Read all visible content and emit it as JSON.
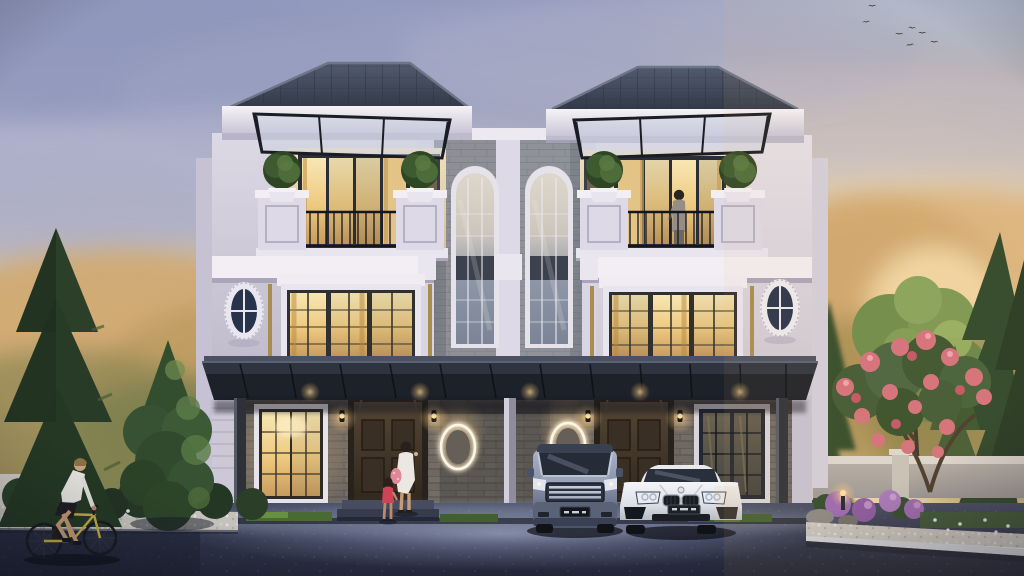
{
  "scene": {
    "description": "Dusk architectural rendering of a symmetrical three-storey twin townhouse (duplex) with hip roofs, white classical facades, a grey stone-clad centre tower with two tall arched windows, balconies with black iron railings and glass awning canopies, a dark carport sheltering a silver-blue minivan and a white sports sedan, warm glowing windows, a woman with a child at the left entrance, a resident on the right balcony, a cyclist passing on the road, pine trees and a pink flowering garden at dusk with birds in the sky",
    "time_of_day": "dusk",
    "weather": "clear with soft clouds",
    "setting": "residential street front"
  },
  "palette": {
    "sky-top": "#939bc0",
    "sky-mid": "#cfc2b2",
    "sky-warm": "#f0d8b4",
    "cloud": "#9aa0c0",
    "roof": "#414a5a",
    "fascia": "#efecf2",
    "wall-light": "#dfdbe6",
    "wall-shadow": "#b9b5ca",
    "stone-upper": "#8e9096",
    "stone-ground": "#6e6862",
    "canopy": "#1d2129",
    "window-glow": "#f3d79a",
    "window-frame": "#2e2a26",
    "door-wood": "#46392b",
    "railing": "#16181e",
    "topiary": "#3d5a30",
    "pine-dark": "#2b3f29",
    "tree-haze-gold": "#d9b27c",
    "foliage-light": "#7e9c54",
    "flower-pink": "#d6707e",
    "flower-purple": "#9a68b2",
    "flower-white": "#e8eaec",
    "garden-wall": "#b3ada6",
    "pebble": "#c5c2be",
    "road": "#2b3042",
    "driveway-pool": "#9aa2c2",
    "curb": "#d4d7de",
    "van-body": "#8791a8",
    "car-white": "#eef0f3",
    "license-plate": "#14161c",
    "glow-warm": "#ffd98c",
    "skin": "#caa47e"
  },
  "elements": {
    "counts": {
      "birds": 7,
      "cars": 2,
      "people": 4,
      "balconies": 2,
      "topiary_balls": 4,
      "arched_windows": 2,
      "oval_side_windows": 2,
      "lit_oval_wall_ornaments": 2,
      "carport_posts": 3,
      "entrance_doors": 2,
      "garden_lights": 2
    },
    "vehicles": [
      {
        "type": "minivan",
        "color": "silver-blue",
        "position": "left bay of carport",
        "license_plate_text_legible": false
      },
      {
        "type": "sports sedan",
        "color": "white",
        "position": "right bay of carport",
        "license_plate_text_legible": false
      }
    ],
    "people": [
      {
        "role": "woman with bag",
        "location": "left entrance steps"
      },
      {
        "role": "child in red",
        "location": "in front of left entrance"
      },
      {
        "role": "resident",
        "location": "right balcony"
      },
      {
        "role": "cyclist",
        "location": "road, lower left"
      }
    ],
    "vegetation": [
      "tall pine left edge",
      "round conifer left of house",
      "golden hazy trees behind left",
      "pine cluster right",
      "light green leafy tree right",
      "pink flowering tree right garden",
      "purple hydrangeas",
      "white ground flowers",
      "white pebble beds",
      "trimmed hedges"
    ]
  }
}
